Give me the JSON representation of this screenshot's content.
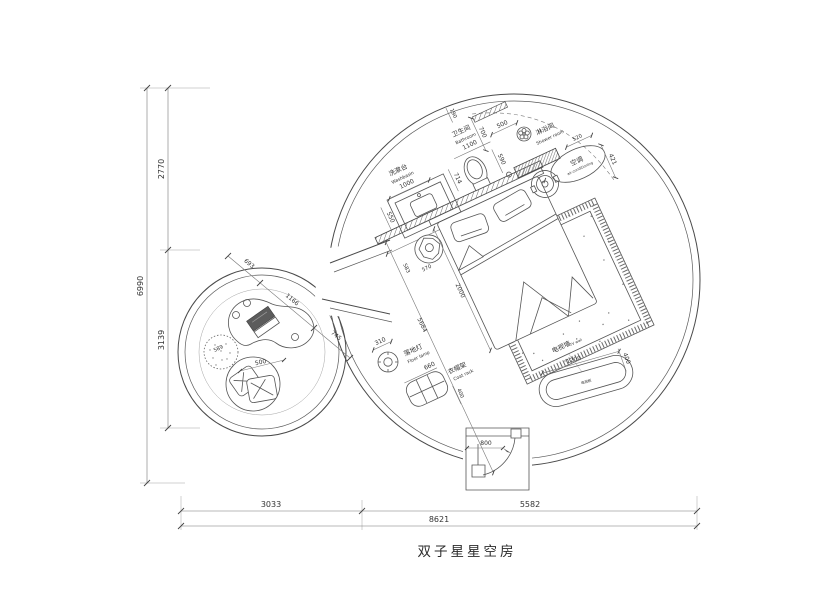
{
  "title": "双子星星空房",
  "border_dims": {
    "height_total": "6990",
    "height_top": "2770",
    "height_bottom": "3139",
    "width_left": "3033",
    "width_right": "5582",
    "width_total": "8621"
  },
  "washbasin": {
    "label_zh": "洗漱台",
    "label_en": "Washbasin",
    "dim_width": "1000",
    "dim_depth": "550"
  },
  "bathroom": {
    "label_zh": "卫生间",
    "label_en": "Bathroom",
    "dim_width": "1100",
    "dim_gap": "190",
    "dim_depth": "700",
    "dim_toilet": "714"
  },
  "shower": {
    "label_zh": "淋浴间",
    "label_en": "Shower room",
    "dim_entry": "500",
    "dim_width": "590",
    "dim_bench": "520"
  },
  "aircon": {
    "label_zh": "空调",
    "label_en": "air-conditioning",
    "dim_clearance": "421"
  },
  "bed_area": {
    "dim_headwall": "1800",
    "dim_bed_length": "2000",
    "dim_diagonal": "5684",
    "dim_stool_a": "583",
    "dim_stool_b": "570"
  },
  "floor_lamp": {
    "label_zh": "落地灯",
    "label_en": "Floor lamp",
    "dim_size": "310"
  },
  "coat_rack": {
    "label_zh": "衣帽架",
    "label_en": "Coat rack",
    "dim_width": "660",
    "dim_depth": "400"
  },
  "tv_wall": {
    "label_zh": "电视墙",
    "label_en": "TV wall",
    "dim_width": "1200",
    "dim_depth": "400",
    "cabinet_label": "电视柜"
  },
  "lounge": {
    "dim_pouf": "589",
    "dim_chair": "500",
    "dim_seg1": "693",
    "dim_seg2": "1166",
    "dim_seg3": "745"
  },
  "entrance": {
    "dim_door": "800"
  }
}
